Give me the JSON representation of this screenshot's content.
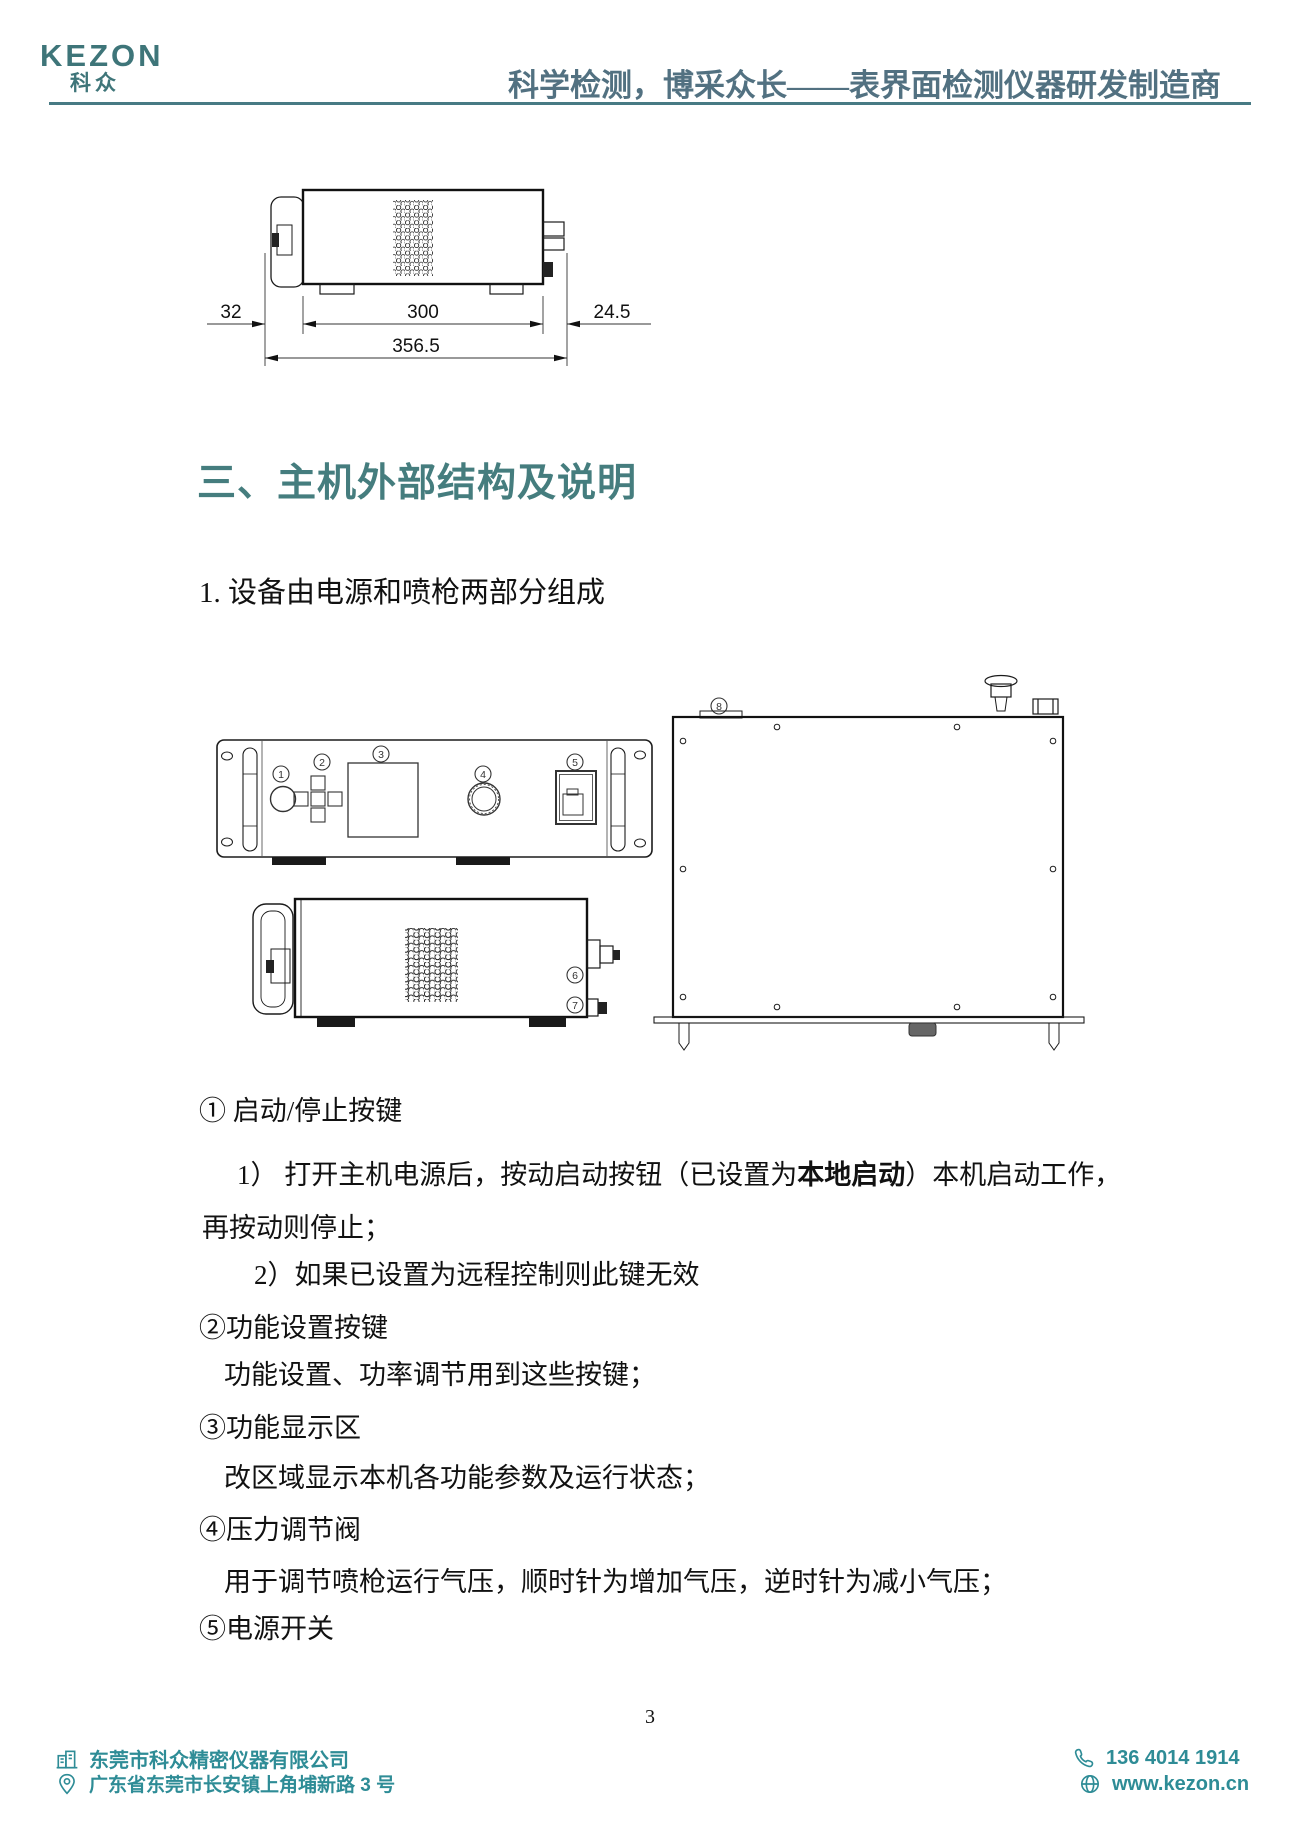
{
  "header": {
    "logo_text": "KEZON",
    "logo_sub": "科众",
    "tagline": "科学检测，博采众长——表界面检测仪器研发制造商"
  },
  "top_drawing": {
    "dim_left": "32",
    "dim_center": "300",
    "dim_right": "24.5",
    "dim_total": "356.5"
  },
  "section": {
    "heading": "三、主机外部结构及说明",
    "intro": "1. 设备由电源和喷枪两部分组成"
  },
  "drawing": {
    "front_markers": [
      "1",
      "2",
      "3",
      "4",
      "5"
    ],
    "side_markers": [
      "6",
      "7"
    ],
    "top_markers": [
      "8"
    ]
  },
  "notes": [
    {
      "pre": "① 启动/停止按键"
    },
    {
      "pre": "1） 打开主机电源后，按动启动按钮（已设置为",
      "bold": "本地启动",
      "post": "）本机启动工作，"
    },
    {
      "pre": "再按动则停止；"
    },
    {
      "pre": "2）如果已设置为远程控制则此键无效"
    },
    {
      "pre": "②功能设置按键"
    },
    {
      "pre": "功能设置、功率调节用到这些按键；"
    },
    {
      "pre": "③功能显示区"
    },
    {
      "pre": "改区域显示本机各功能参数及运行状态；"
    },
    {
      "pre": "④压力调节阀"
    },
    {
      "pre": "用于调节喷枪运行气压，顺时针为增加气压，逆时针为减小气压；"
    },
    {
      "pre": "⑤电源开关"
    }
  ],
  "footer": {
    "page_number": "3",
    "company": "东莞市科众精密仪器有限公司",
    "address": "广东省东莞市长安镇上角埔新路 3 号",
    "phone": "136 4014 1914",
    "website": "www.kezon.cn"
  },
  "colors": {
    "logo_teal": "#3e7579",
    "heading_teal": "#457d7e",
    "tagline_blue": "#527181",
    "footer_teal": "#2e8c96"
  }
}
